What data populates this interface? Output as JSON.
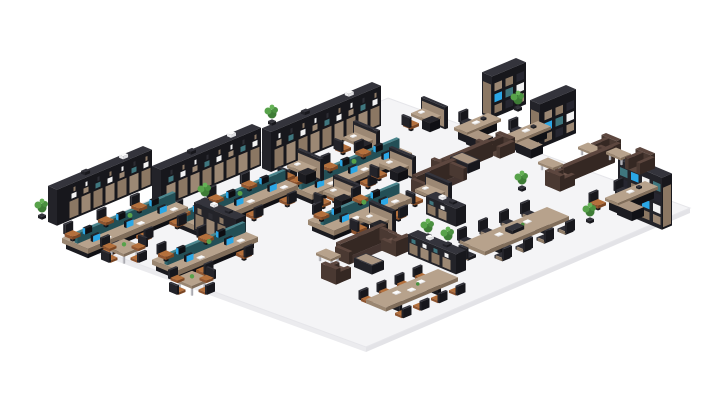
{
  "scene": {
    "name": "isometric-office-floorplan-render",
    "canvas": {
      "width": 712,
      "height": 400,
      "background": "#ffffff"
    },
    "floor": {
      "corners": [
        [
          388,
          98
        ],
        [
          690,
          208
        ],
        [
          366,
          347
        ],
        [
          64,
          237
        ]
      ],
      "fill": "#f4f4f6",
      "edge": "#e6e6ea",
      "side_left": "#ebebee",
      "side_right": "#e3e3e7",
      "thickness": 5
    },
    "palette": {
      "dark": [
        "#34343c",
        "#232329",
        "#17171c"
      ],
      "dark_base": [
        "#26262c",
        "#1b1b20",
        "#101014"
      ],
      "wood": [
        "#ab9682",
        "#93806b",
        "#7a6856"
      ],
      "wood_top": [
        "#b7a28c",
        "#9a8671",
        "#806d5a"
      ],
      "teal": [
        "#4b868e",
        "#2f666e",
        "#234f56"
      ],
      "sofa": [
        "#6f574d",
        "#5a463e",
        "#443430"
      ],
      "sofa_dark": [
        "#5d473f",
        "#4a3932",
        "#352823"
      ],
      "metal": [
        "#d2d2d6",
        "#bdbdc2",
        "#a9a9af"
      ],
      "white": [
        "#fbfbfb",
        "#ececee",
        "#dfdfe2"
      ],
      "monitor_blue": "#2ba7e6",
      "panel_wood": "#9c8874",
      "panel_wood_dark": "#8b7763",
      "panel_dark": "#2c2c33",
      "accent_teal": "#3f767e",
      "item_white": "#f2f2f2",
      "plant_greens": [
        "#3e7c36",
        "#57a24a",
        "#4a9040",
        "#65b156"
      ],
      "chair_orange": [
        "#b4703c",
        "#8f5530",
        "#7a4623"
      ],
      "chair_dark_seat": [
        "#2f2f37",
        "#222228",
        "#17171c"
      ]
    },
    "objects": [
      {
        "type": "shelfwall",
        "x": 143,
        "y": 182,
        "len": 95,
        "h": 36
      },
      {
        "type": "shelfwall",
        "x": 252,
        "y": 162,
        "len": 100,
        "h": 38
      },
      {
        "type": "shelfwall",
        "x": 372,
        "y": 122,
        "len": 110,
        "h": 40
      },
      {
        "type": "bench",
        "x": 162,
        "y": 208,
        "len": 100,
        "seats": 3
      },
      {
        "type": "bench",
        "x": 272,
        "y": 186,
        "len": 100,
        "seats": 3
      },
      {
        "type": "bench",
        "x": 386,
        "y": 154,
        "len": 100,
        "seats": 3
      },
      {
        "type": "bench",
        "x": 386,
        "y": 199,
        "len": 78,
        "seats": 2
      },
      {
        "type": "bench",
        "x": 232,
        "y": 238,
        "len": 80,
        "seats": 2
      },
      {
        "type": "pod",
        "x": 300,
        "y": 170
      },
      {
        "type": "pod",
        "x": 336,
        "y": 196
      },
      {
        "type": "pod",
        "x": 372,
        "y": 222
      },
      {
        "type": "pod",
        "x": 356,
        "y": 142
      },
      {
        "type": "pod",
        "x": 392,
        "y": 168
      },
      {
        "type": "pod",
        "x": 428,
        "y": 194
      },
      {
        "type": "pod",
        "x": 424,
        "y": 118
      },
      {
        "type": "sqtable",
        "x": 124,
        "y": 252
      },
      {
        "type": "sqtable",
        "x": 192,
        "y": 284
      },
      {
        "type": "lowcab",
        "x": 204,
        "y": 226,
        "len": 42,
        "h": 28,
        "orient": "u",
        "teal": false
      },
      {
        "type": "lowcab",
        "x": 418,
        "y": 250,
        "len": 48,
        "h": 20,
        "orient": "u",
        "teal": true
      },
      {
        "type": "lowcab",
        "x": 436,
        "y": 210,
        "len": 30,
        "h": 18,
        "orient": "u",
        "teal": true
      },
      {
        "type": "meettable",
        "x": 438,
        "y": 282,
        "len": 72,
        "w": 20,
        "chairs": 4,
        "chair": "cant",
        "console": false,
        "head": false
      },
      {
        "type": "meettable",
        "x": 547,
        "y": 220,
        "len": 84,
        "w": 22,
        "chairs": 4,
        "chair": "conf",
        "console": true,
        "head": true
      },
      {
        "type": "sofa",
        "x": 600,
        "y": 157,
        "len": 50,
        "back": "dr"
      },
      {
        "type": "armchair",
        "x": 606,
        "y": 148,
        "back": "ur"
      },
      {
        "type": "armchair",
        "x": 560,
        "y": 179,
        "back": "dl"
      },
      {
        "type": "ctable",
        "x": 588,
        "y": 151
      },
      {
        "type": "ctable",
        "x": 548,
        "y": 166
      },
      {
        "type": "sofa",
        "x": 478,
        "y": 151,
        "len": 46,
        "back": "dr"
      },
      {
        "type": "sofa",
        "x": 452,
        "y": 174,
        "len": 40,
        "back": "ul"
      },
      {
        "type": "ctabledark",
        "x": 462,
        "y": 161
      },
      {
        "type": "armchair",
        "x": 500,
        "y": 146,
        "back": "ur"
      },
      {
        "type": "sofa",
        "x": 382,
        "y": 239,
        "len": 46,
        "back": "ul"
      },
      {
        "type": "armchair",
        "x": 396,
        "y": 244,
        "back": "dr"
      },
      {
        "type": "armchair",
        "x": 336,
        "y": 272,
        "back": "dl"
      },
      {
        "type": "ctabledark",
        "x": 366,
        "y": 262
      },
      {
        "type": "ctable",
        "x": 326,
        "y": 257
      },
      {
        "type": "ctable",
        "x": 374,
        "y": 238
      },
      {
        "type": "execdesk",
        "x": 488,
        "y": 125,
        "len": 34
      },
      {
        "type": "bookcase",
        "x": 516,
        "y": 100,
        "len": 34,
        "h": 42,
        "orient": "v"
      },
      {
        "type": "execdesk",
        "x": 538,
        "y": 133,
        "len": 34
      },
      {
        "type": "bookcase",
        "x": 566,
        "y": 129,
        "len": 36,
        "h": 44,
        "orient": "v"
      },
      {
        "type": "execdesk",
        "x": 645,
        "y": 193,
        "len": 40
      },
      {
        "type": "bookcase",
        "x": 628,
        "y": 207,
        "len": 44,
        "h": 52,
        "orient": "u",
        "sort": -44
      },
      {
        "type": "chair",
        "x": 598,
        "y": 206,
        "back": "ul"
      },
      {
        "type": "armchair",
        "x": 640,
        "y": 162,
        "back": "ur",
        "sort": 20
      },
      {
        "type": "ctable",
        "x": 616,
        "y": 156,
        "sort": 20
      },
      {
        "type": "plant",
        "x": 42,
        "y": 218
      },
      {
        "type": "plant",
        "x": 139,
        "y": 176
      },
      {
        "type": "plant",
        "x": 246,
        "y": 156
      },
      {
        "type": "plant",
        "x": 272,
        "y": 124
      },
      {
        "type": "plant",
        "x": 205,
        "y": 202
      },
      {
        "type": "plant",
        "x": 518,
        "y": 110
      },
      {
        "type": "plant",
        "x": 522,
        "y": 190
      },
      {
        "type": "plant",
        "x": 590,
        "y": 222
      },
      {
        "type": "plant",
        "x": 428,
        "y": 238
      },
      {
        "type": "plant",
        "x": 448,
        "y": 246
      }
    ]
  }
}
